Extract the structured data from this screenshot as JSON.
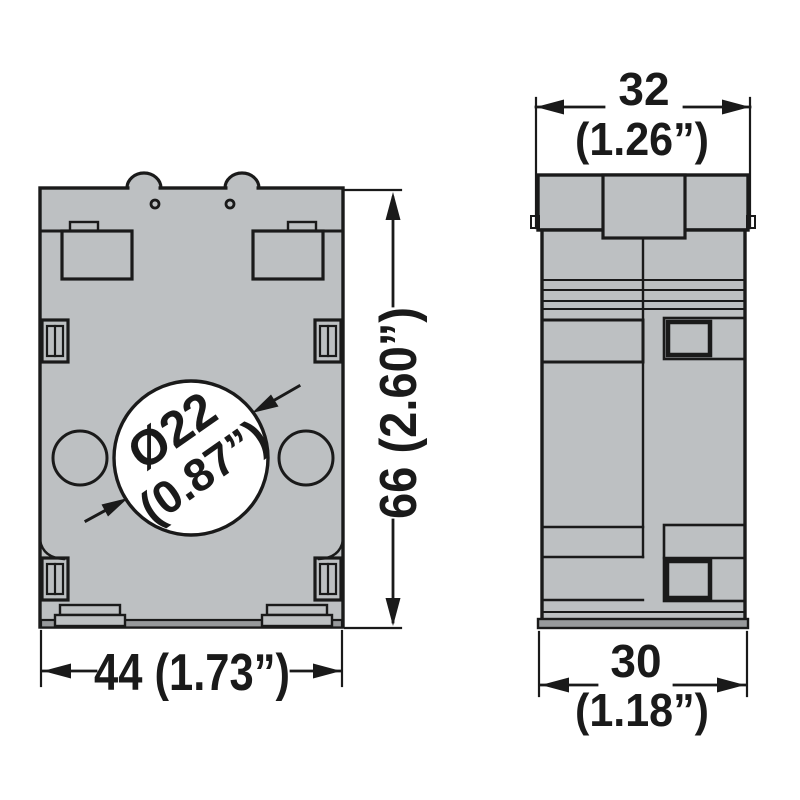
{
  "front_view": {
    "hole_diameter_mm": "Ø22",
    "hole_diameter_in": "(0.87”)",
    "width_label": "44 (1.73”)",
    "height_label": "66 (2.60”)"
  },
  "side_view": {
    "top_width_mm": "32",
    "top_width_in": "(1.26”)",
    "bottom_width_mm": "30",
    "bottom_width_in": "(1.18”)"
  },
  "colors": {
    "body_fill": "#bdc0c2",
    "base_strip_fill": "#97999b",
    "outline": "#1a1a1a",
    "background": "#ffffff"
  }
}
